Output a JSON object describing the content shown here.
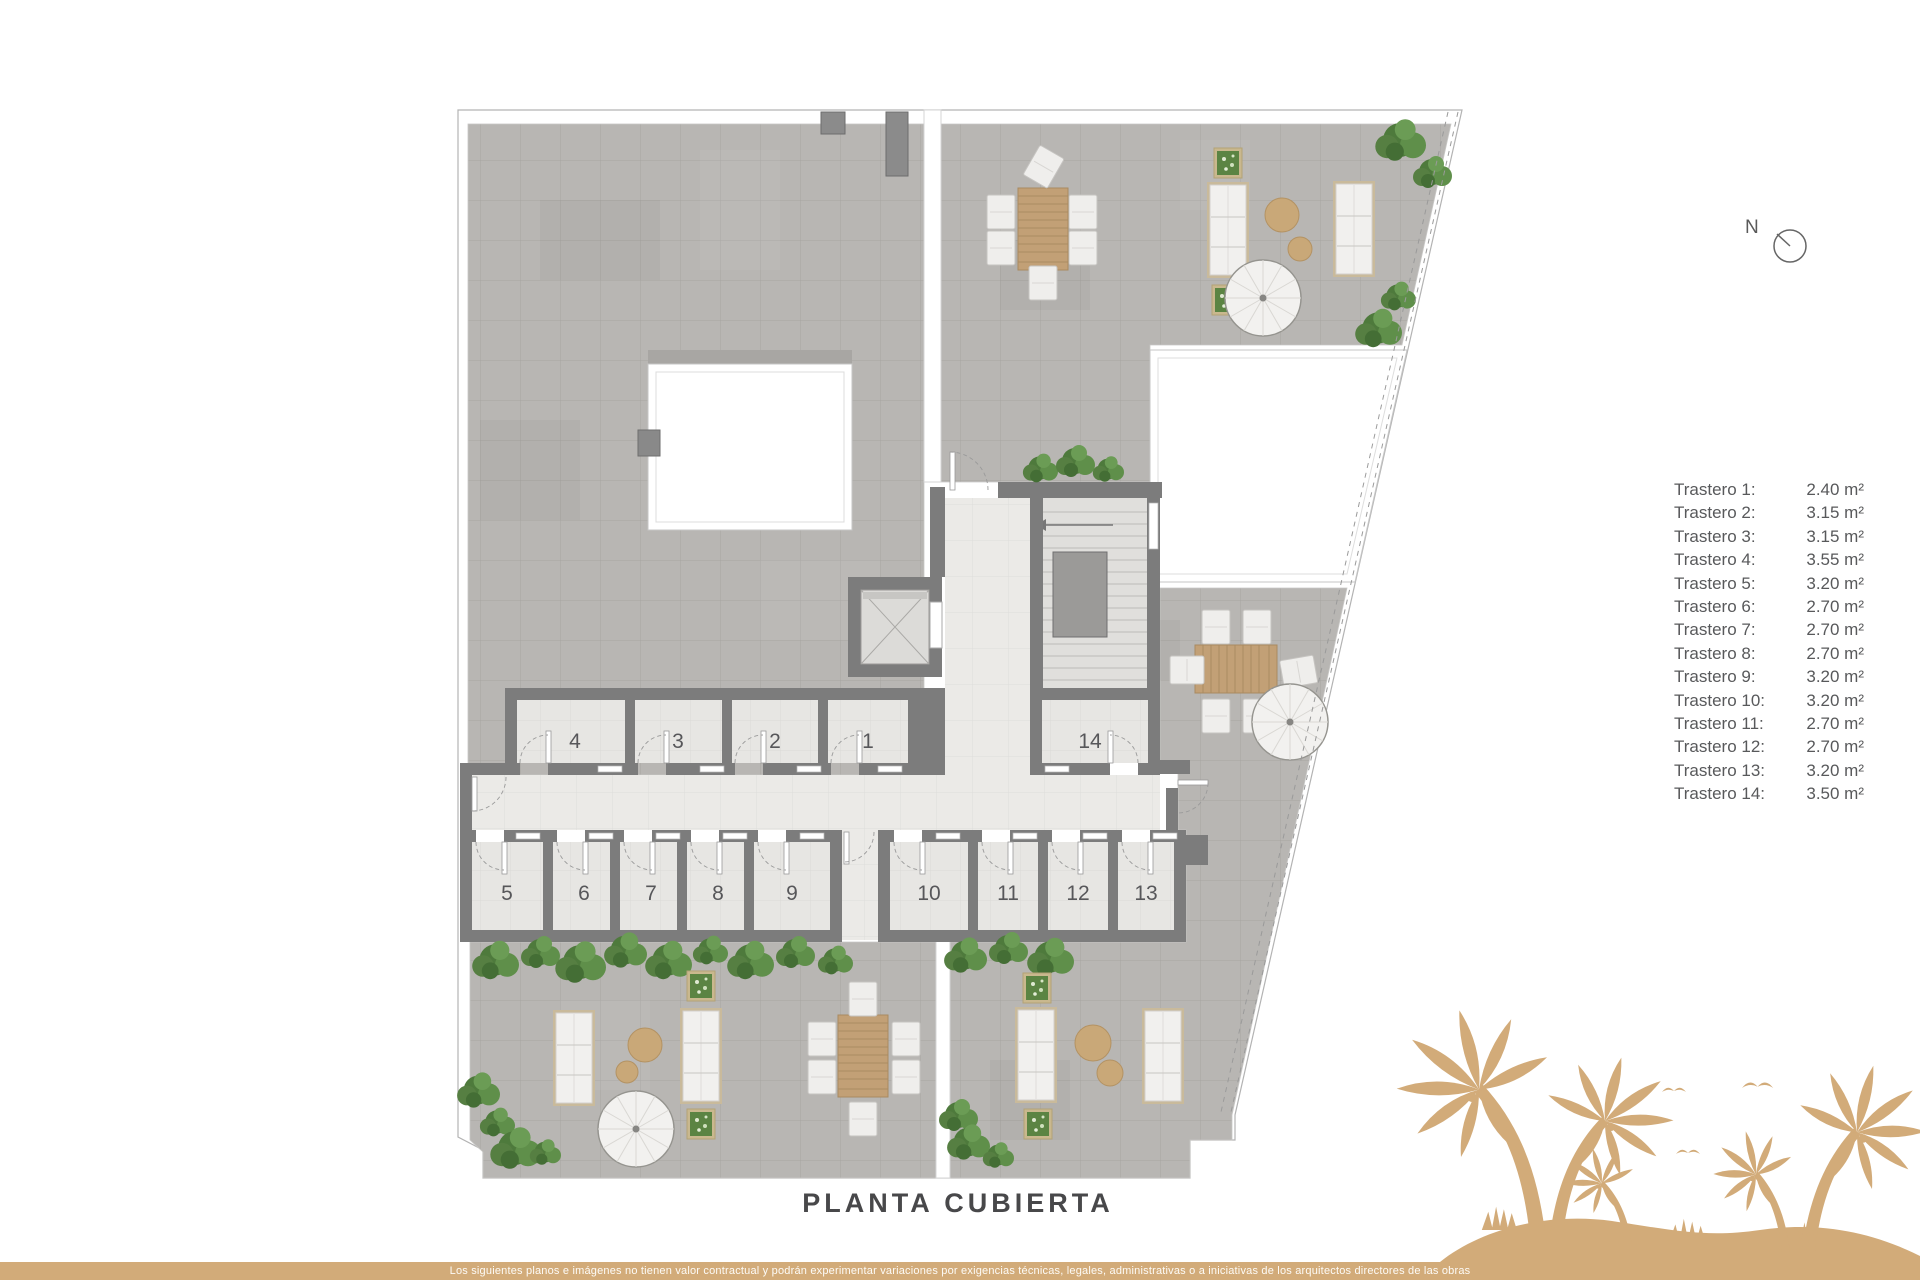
{
  "title": "PLANTA CUBIERTA",
  "compass": {
    "label": "N"
  },
  "legend": {
    "items": [
      {
        "label": "Trastero 1:",
        "value": "2.40 m²"
      },
      {
        "label": "Trastero 2:",
        "value": "3.15 m²"
      },
      {
        "label": "Trastero 3:",
        "value": "3.15 m²"
      },
      {
        "label": "Trastero 4:",
        "value": "3.55 m²"
      },
      {
        "label": "Trastero 5:",
        "value": "3.20 m²"
      },
      {
        "label": "Trastero 6:",
        "value": "2.70 m²"
      },
      {
        "label": "Trastero 7:",
        "value": "2.70 m²"
      },
      {
        "label": "Trastero 8:",
        "value": "2.70 m²"
      },
      {
        "label": "Trastero 9:",
        "value": "3.20 m²"
      },
      {
        "label": "Trastero 10:",
        "value": "3.20 m²"
      },
      {
        "label": "Trastero 11:",
        "value": "2.70 m²"
      },
      {
        "label": "Trastero 12:",
        "value": "2.70 m²"
      },
      {
        "label": "Trastero 13:",
        "value": "3.20 m²"
      },
      {
        "label": "Trastero 14:",
        "value": "3.50 m²"
      }
    ]
  },
  "plan": {
    "rooms": [
      {
        "number": "1"
      },
      {
        "number": "2"
      },
      {
        "number": "3"
      },
      {
        "number": "4"
      },
      {
        "number": "5"
      },
      {
        "number": "6"
      },
      {
        "number": "7"
      },
      {
        "number": "8"
      },
      {
        "number": "9"
      },
      {
        "number": "10"
      },
      {
        "number": "11"
      },
      {
        "number": "12"
      },
      {
        "number": "13"
      },
      {
        "number": "14"
      }
    ]
  },
  "footer": {
    "disclaimer": "Los siguientes planos e imágenes no tienen valor contractual y podrán experimentar variaciones por exigencias técnicas, legales, administrativas o a iniciativas de los arquitectos directores de las obras"
  },
  "colors": {
    "accent_gold": "#d2ab79",
    "wall_gray": "#7c7c7c",
    "tile_gray": "#b8b6b3",
    "plant_green": "#4e7a3c",
    "wood_tan": "#c2a076",
    "legend_text": "#58595b"
  }
}
